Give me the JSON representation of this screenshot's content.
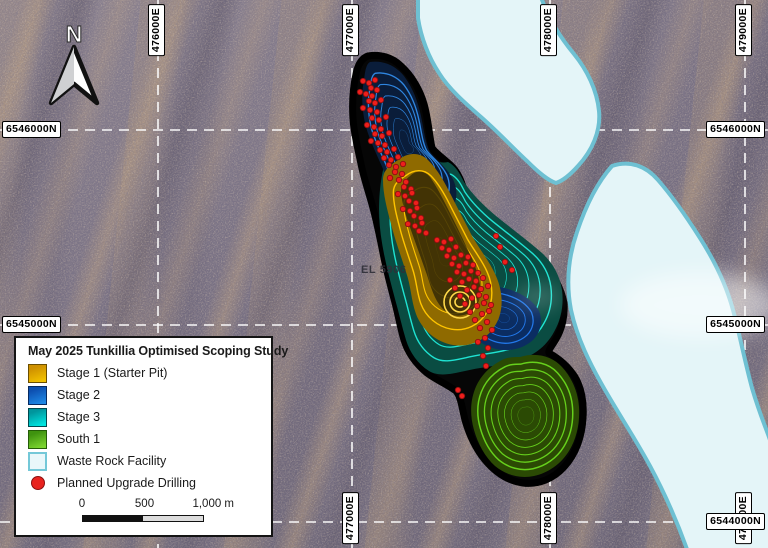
{
  "map": {
    "north_label": "N",
    "el_label": "EL 5906",
    "gridlines": {
      "vertical_x": [
        158,
        352,
        550,
        745
      ],
      "horizontal_y": [
        130,
        325,
        522
      ]
    },
    "grid_labels": {
      "top": [
        {
          "text": "476000E",
          "x": 158
        },
        {
          "text": "477000E",
          "x": 352
        },
        {
          "text": "478000E",
          "x": 550
        },
        {
          "text": "479000E",
          "x": 745
        }
      ],
      "bottom": [
        {
          "text": "477000E",
          "x": 352
        },
        {
          "text": "478000E",
          "x": 550
        },
        {
          "text": "479000E",
          "x": 745
        }
      ],
      "left": [
        {
          "text": "6546000N",
          "y": 130
        },
        {
          "text": "6545000N",
          "y": 325
        }
      ],
      "right": [
        {
          "text": "6546000N",
          "y": 130
        },
        {
          "text": "6545000N",
          "y": 325
        },
        {
          "text": "6544000N",
          "y": 522
        }
      ]
    }
  },
  "legend": {
    "title": "May 2025 Tunkillia Optimised Scoping Study",
    "items": [
      {
        "id": "stage1",
        "label": "Stage 1 (Starter Pit)",
        "type": "swatch",
        "color": "#CE9000",
        "color2": "#F2C200",
        "border": "#6b4e00"
      },
      {
        "id": "stage2",
        "label": "Stage 2",
        "type": "swatch",
        "color": "#0D4FB0",
        "color2": "#1E88E5",
        "border": "#072a60"
      },
      {
        "id": "stage3",
        "label": "Stage 3",
        "type": "swatch",
        "color": "#00959C",
        "color2": "#00E5E0",
        "border": "#00494e"
      },
      {
        "id": "south1",
        "label": "South 1",
        "type": "swatch",
        "color": "#3F930F",
        "color2": "#7CD530",
        "border": "#245c08"
      },
      {
        "id": "wrf",
        "label": "Waste Rock Facility",
        "type": "swatch",
        "color": "#E9F7FA",
        "color2": "#E9F7FA",
        "border": "#74C8D8"
      },
      {
        "id": "drilling",
        "label": "Planned Upgrade Drilling",
        "type": "dot",
        "color": "#E8231E",
        "border": "#8a1010"
      }
    ],
    "scalebar": {
      "ticks": [
        "0",
        "500",
        "1,000 m"
      ]
    }
  },
  "layers": {
    "wrf_fill": "#E4F5F8",
    "wrf_border": "#6EC0D2",
    "pit_outline": "#000000",
    "drill_color": "#EE1F1C",
    "grid_color": "#FFFFFF"
  },
  "drill_points": [
    [
      363,
      81
    ],
    [
      369,
      83
    ],
    [
      375,
      80
    ],
    [
      371,
      88
    ],
    [
      377,
      90
    ],
    [
      360,
      92
    ],
    [
      366,
      94
    ],
    [
      372,
      96
    ],
    [
      369,
      101
    ],
    [
      375,
      103
    ],
    [
      381,
      100
    ],
    [
      363,
      108
    ],
    [
      370,
      110
    ],
    [
      377,
      112
    ],
    [
      372,
      118
    ],
    [
      379,
      120
    ],
    [
      386,
      117
    ],
    [
      367,
      125
    ],
    [
      374,
      127
    ],
    [
      381,
      129
    ],
    [
      375,
      134
    ],
    [
      382,
      136
    ],
    [
      389,
      133
    ],
    [
      371,
      141
    ],
    [
      378,
      143
    ],
    [
      385,
      145
    ],
    [
      380,
      150
    ],
    [
      387,
      152
    ],
    [
      394,
      149
    ],
    [
      384,
      158
    ],
    [
      391,
      160
    ],
    [
      398,
      157
    ],
    [
      389,
      165
    ],
    [
      396,
      167
    ],
    [
      403,
      164
    ],
    [
      395,
      172
    ],
    [
      402,
      174
    ],
    [
      390,
      178
    ],
    [
      399,
      180
    ],
    [
      406,
      182
    ],
    [
      404,
      187
    ],
    [
      411,
      189
    ],
    [
      398,
      194
    ],
    [
      405,
      196
    ],
    [
      412,
      193
    ],
    [
      409,
      201
    ],
    [
      416,
      203
    ],
    [
      403,
      209
    ],
    [
      410,
      211
    ],
    [
      417,
      208
    ],
    [
      414,
      216
    ],
    [
      421,
      218
    ],
    [
      408,
      224
    ],
    [
      415,
      226
    ],
    [
      422,
      223
    ],
    [
      419,
      231
    ],
    [
      426,
      233
    ],
    [
      437,
      240
    ],
    [
      444,
      242
    ],
    [
      451,
      239
    ],
    [
      496,
      236
    ],
    [
      442,
      248
    ],
    [
      449,
      250
    ],
    [
      456,
      247
    ],
    [
      500,
      247
    ],
    [
      447,
      256
    ],
    [
      454,
      258
    ],
    [
      461,
      255
    ],
    [
      468,
      257
    ],
    [
      505,
      262
    ],
    [
      452,
      264
    ],
    [
      459,
      266
    ],
    [
      466,
      263
    ],
    [
      473,
      265
    ],
    [
      512,
      270
    ],
    [
      457,
      272
    ],
    [
      464,
      274
    ],
    [
      471,
      271
    ],
    [
      478,
      273
    ],
    [
      450,
      280
    ],
    [
      462,
      282
    ],
    [
      469,
      279
    ],
    [
      476,
      281
    ],
    [
      483,
      278
    ],
    [
      455,
      288
    ],
    [
      467,
      290
    ],
    [
      474,
      287
    ],
    [
      481,
      289
    ],
    [
      488,
      286
    ],
    [
      460,
      296
    ],
    [
      472,
      298
    ],
    [
      479,
      295
    ],
    [
      486,
      297
    ],
    [
      465,
      304
    ],
    [
      477,
      306
    ],
    [
      484,
      303
    ],
    [
      491,
      305
    ],
    [
      470,
      312
    ],
    [
      482,
      314
    ],
    [
      489,
      311
    ],
    [
      475,
      320
    ],
    [
      487,
      322
    ],
    [
      480,
      328
    ],
    [
      492,
      330
    ],
    [
      485,
      338
    ],
    [
      478,
      342
    ],
    [
      488,
      348
    ],
    [
      483,
      356
    ],
    [
      486,
      366
    ],
    [
      458,
      390
    ],
    [
      462,
      396
    ]
  ]
}
